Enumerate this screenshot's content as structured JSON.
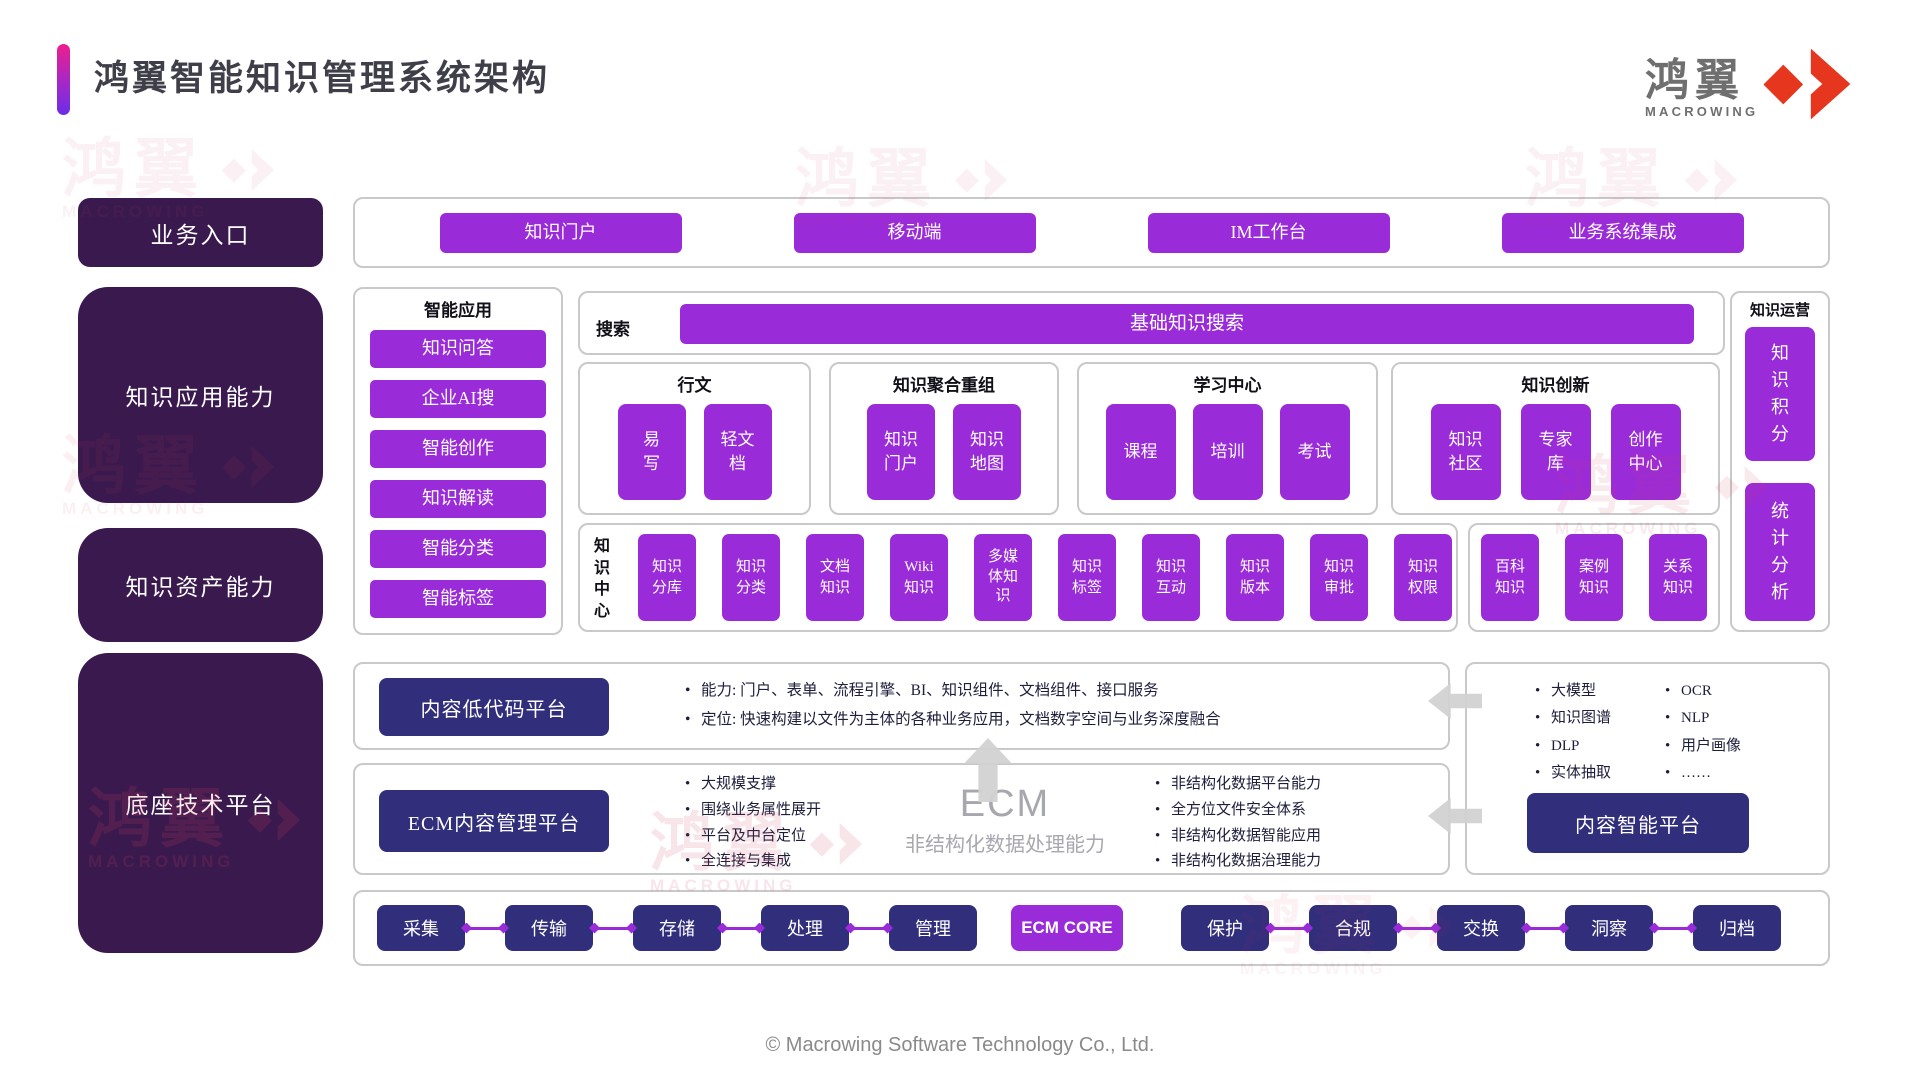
{
  "header": {
    "title": "鸿翼智能知识管理系统架构",
    "logo_text": "鸿翼",
    "logo_sub": "MACROWING"
  },
  "left_rail": {
    "items": [
      "业务入口",
      "知识应用能力",
      "知识资产能力",
      "底座技术平台"
    ]
  },
  "entry": {
    "items": [
      "知识门户",
      "移动端",
      "IM工作台",
      "业务系统集成"
    ]
  },
  "smart_apps": {
    "title": "智能应用",
    "items": [
      "知识问答",
      "企业AI搜",
      "智能创作",
      "知识解读",
      "智能分类",
      "智能标签"
    ]
  },
  "search": {
    "label": "搜索",
    "bar_label": "基础知识搜索"
  },
  "sections": [
    {
      "title": "行文",
      "items": [
        "易\n写",
        "轻文\n档"
      ]
    },
    {
      "title": "知识聚合重组",
      "items": [
        "知识\n门户",
        "知识\n地图"
      ]
    },
    {
      "title": "学习中心",
      "items": [
        "课程",
        "培训",
        "考试"
      ]
    },
    {
      "title": "知识创新",
      "items": [
        "知识\n社区",
        "专家\n库",
        "创作\n中心"
      ]
    }
  ],
  "knowledge_center": {
    "label": "知\n识\n中\n心",
    "items": [
      "知识\n分库",
      "知识\n分类",
      "文档\n知识",
      "Wiki\n知识",
      "多媒\n体知\n识",
      "知识\n标签",
      "知识\n互动",
      "知识\n版本",
      "知识\n审批",
      "知识\n权限"
    ]
  },
  "knowledge_types": {
    "items": [
      "百科\n知识",
      "案例\n知识",
      "关系\n知识"
    ]
  },
  "operations": {
    "title": "知识运营",
    "items": [
      "知\n识\n积\n分",
      "统\n计\n分\n析"
    ]
  },
  "lowcode": {
    "name": "内容低代码平台",
    "bullets": [
      "能力: 门户、表单、流程引擎、BI、知识组件、文档组件、接口服务",
      "定位: 快速构建以文件为主体的各种业务应用，文档数字空间与业务深度融合"
    ]
  },
  "ecm": {
    "name": "ECM内容管理平台",
    "left_bullets": [
      "大规模支撑",
      "围绕业务属性展开",
      "平台及中台定位",
      "全连接与集成"
    ],
    "center_title": "ECM",
    "center_sub": "非结构化数据处理能力",
    "right_bullets": [
      "非结构化数据平台能力",
      "全方位文件安全体系",
      "非结构化数据智能应用",
      "非结构化数据治理能力"
    ]
  },
  "intelligence": {
    "name": "内容智能平台",
    "col1": [
      "大模型",
      "知识图谱",
      "DLP",
      "实体抽取"
    ],
    "col2": [
      "OCR",
      "NLP",
      "用户画像",
      "……"
    ]
  },
  "pipeline": {
    "left": [
      "采集",
      "传输",
      "存储",
      "处理",
      "管理"
    ],
    "core": "ECM CORE",
    "right": [
      "保护",
      "合规",
      "交换",
      "洞察",
      "归档"
    ]
  },
  "footer": {
    "copyright": "© Macrowing Software Technology Co., Ltd."
  },
  "colors": {
    "accent_purple": "#9a2bd9",
    "deep_purple": "#3a1a4e",
    "indigo": "#312e7c",
    "brand_red": "#e6371e",
    "border_gray": "#c9c9c9",
    "bullet_text": "#1d1d3c",
    "ecm_gray": "#a7a7ae",
    "footer_gray": "#8a8a8a",
    "logo_gray": "#6f6f6f",
    "watermark_pink": "#cf3d5e"
  }
}
